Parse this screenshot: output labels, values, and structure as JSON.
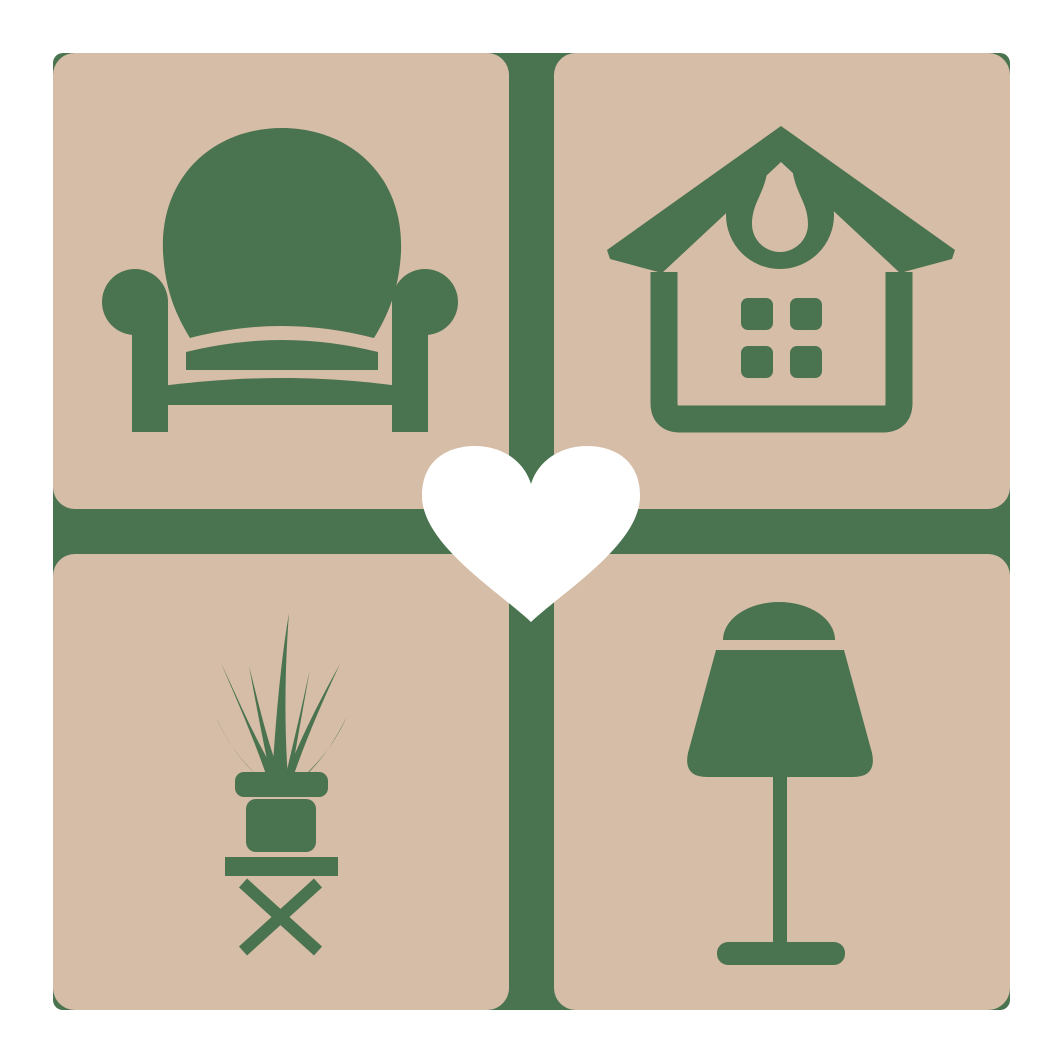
{
  "logo": {
    "center_icon": "heart-icon",
    "tiles": [
      {
        "position": "top-left",
        "icon": "armchair-icon"
      },
      {
        "position": "top-right",
        "icon": "house-icon"
      },
      {
        "position": "bottom-left",
        "icon": "potted-plant-icon"
      },
      {
        "position": "bottom-right",
        "icon": "table-lamp-icon"
      }
    ]
  },
  "colors": {
    "page_background": "#ffffff",
    "tile_tan": "#d6bda7",
    "icon_green": "#4a734f",
    "heart_white": "#ffffff"
  }
}
